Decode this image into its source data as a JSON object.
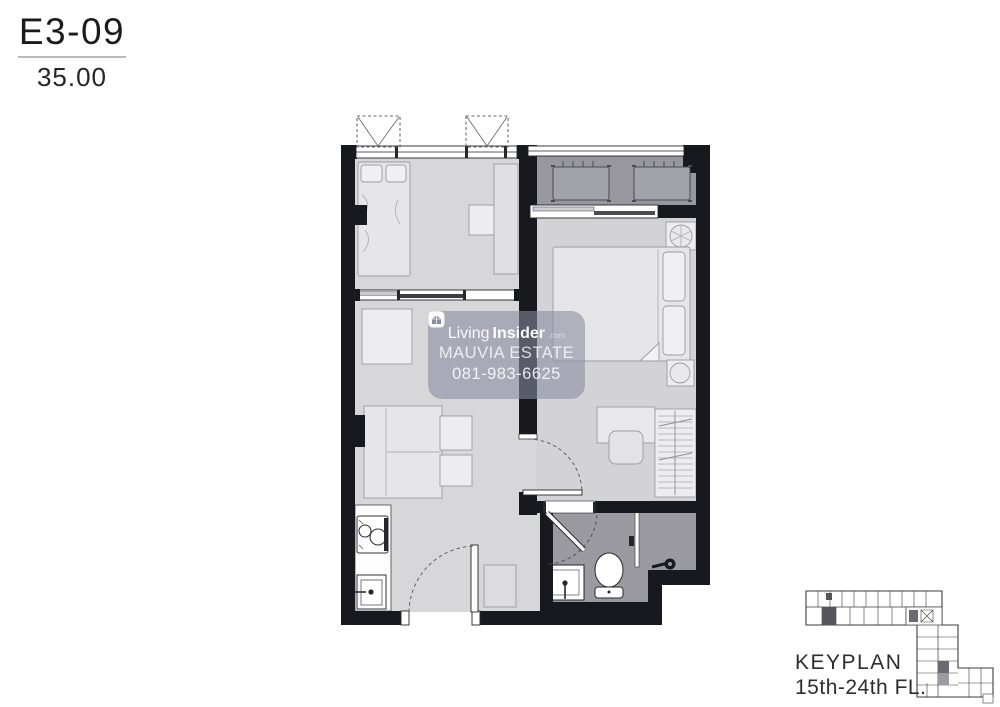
{
  "unit_info": {
    "code": "E3-09",
    "area": "35.00"
  },
  "watermark": {
    "logo_icon": "house-cube-icon",
    "brand_prefix": "Living",
    "brand_suffix": "Insider",
    "brand_domain": ".com",
    "estate_name": "MAUVIA ESTATE",
    "phone": "081-983-6625"
  },
  "keyplan": {
    "title": "KEYPLAN",
    "floors": "15th-24th FL."
  },
  "colors": {
    "wall": "#18181f",
    "floor_light": "#d7d7d9",
    "floor_balcony": "#97979d",
    "floor_bathroom": "#9a9aa0",
    "furniture_fill": "#e6e6e8",
    "watermark_background": "rgba(134,139,158,0.58)",
    "keyplan_highlight": "#55555c",
    "text_dark": "#1b1b1b"
  },
  "plan_symbols": [
    "bed-symbol",
    "pillow-symbol",
    "sofa-symbol",
    "coffee-table-symbol",
    "stove-symbol",
    "kitchen-sink-symbol",
    "toilet-symbol",
    "basin-symbol",
    "shower-head-symbol",
    "shower-glass-symbol",
    "wardrobe-symbol",
    "desk-chair-symbol",
    "ac-condenser-symbol",
    "ac-unit-dashed-symbol",
    "door-swing-symbol",
    "sliding-door-symbol",
    "window-symbol"
  ]
}
